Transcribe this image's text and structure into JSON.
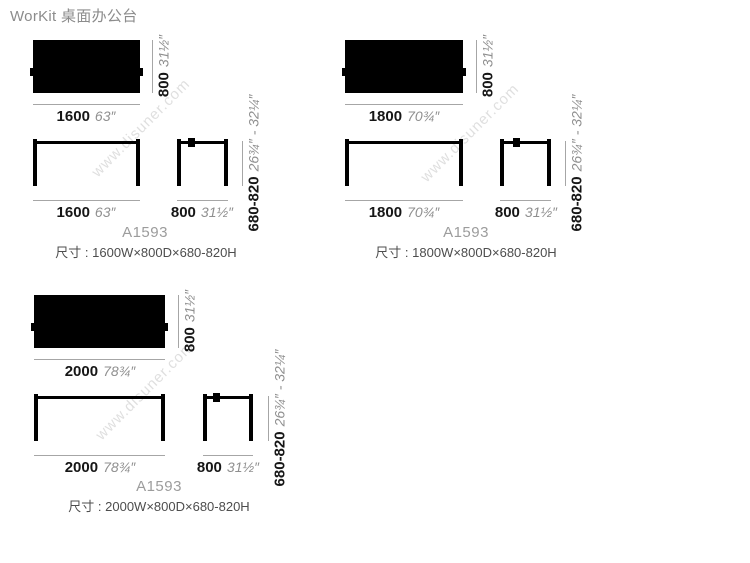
{
  "title": "WorKit 桌面办公台",
  "watermark_text": "www.disuner.com",
  "colors": {
    "drawing_black": "#000000",
    "dimension_line_gray": "#a6a6a6",
    "inch_text_gray": "#8f8f8f",
    "mm_text_dark": "#161616",
    "model_gray": "#9c9c9c",
    "spec_text_gray": "#4d4d4d"
  },
  "groups": [
    {
      "width_mm": "1600",
      "width_inch": "63″",
      "depth_mm": "800",
      "depth_inch": "31½″",
      "height_mm": "680-820",
      "height_inch": "26¾″ - 32¼″",
      "model": "A1593",
      "size_label": "尺寸 : 1600W×800D×680-820H"
    },
    {
      "width_mm": "1800",
      "width_inch": "70¾″",
      "depth_mm": "800",
      "depth_inch": "31½″",
      "height_mm": "680-820",
      "height_inch": "26¾″ - 32¼″",
      "model": "A1593",
      "size_label": "尺寸 : 1800W×800D×680-820H"
    },
    {
      "width_mm": "2000",
      "width_inch": "78¾″",
      "depth_mm": "800",
      "depth_inch": "31½″",
      "height_mm": "680-820",
      "height_inch": "26¾″ - 32¼″",
      "model": "A1593",
      "size_label": "尺寸 : 2000W×800D×680-820H"
    }
  ]
}
